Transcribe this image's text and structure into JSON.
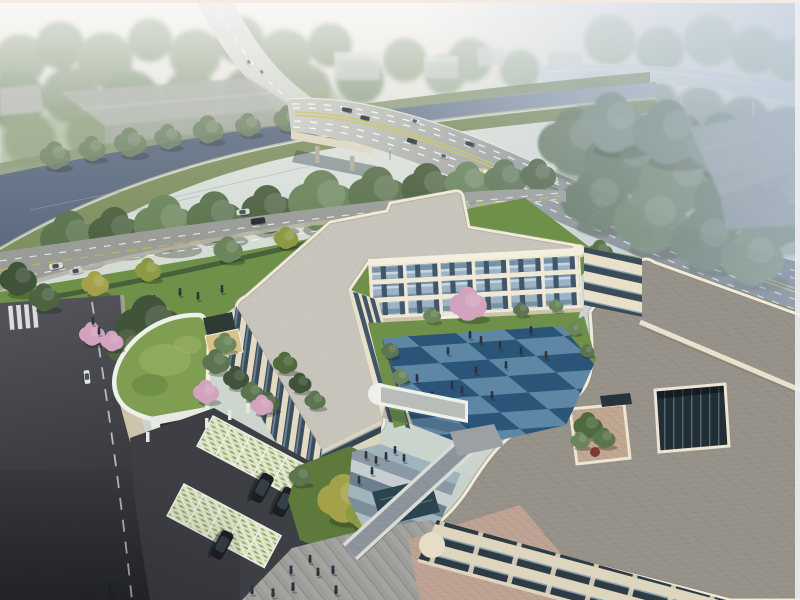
{
  "scene": {
    "title": "Aerial architectural rendering of a cream three-storey courtyard campus beside a canal and a curving elevated highway",
    "style": "daytime hazy architectural visualization, no visible text",
    "view": "high-angle aerial view looking toward a tree-lined canal, a road bridge and distant forest"
  },
  "features": [
    "hazy sky band",
    "distant forest",
    "distant highway ramp",
    "canal with bridge",
    "tree rows along canal",
    "main avenue with traffic",
    "local street",
    "cream building complex with rounded corners",
    "blue checkerboard courtyard with pedestrians",
    "grey paver roof with square skylight opening",
    "roof terrace with planting",
    "curved green-roof gatehouse",
    "entry gate and driveway",
    "grass-paver parking bays with black SUVs",
    "front plaza with pedestrians",
    "pink blossom trees"
  ],
  "counts": {
    "highway_cars": 9,
    "highway_buses": 1,
    "street_cars": 2,
    "parked_vans": 2,
    "access_road_cars": 2,
    "parked_suvs": 3,
    "distant_buildings": 4,
    "canal_warehouses": 3,
    "people_courtyard": 14,
    "people_forecourt": 7,
    "people_plaza": 8,
    "people_lawn": 4,
    "people_path": 2,
    "blossom_trees": 5
  },
  "colors": {
    "top_border": "#f3eae3",
    "right_border": "#edf0f2",
    "canal_water": "#5d6c80",
    "street_asphalt": "#9a9d97",
    "driveway_asphalt": "#3d3f44",
    "roof_left_wing": "#c8c5bd",
    "roof_right_wing": "#97928a",
    "facade_cream": "#efe8d4",
    "parapet_cream": "#f0ead9",
    "courtyard_tile_light": "#5e87a5",
    "courtyard_tile_dark": "#2b5578",
    "lawn": "#6f9049",
    "green_roof": "#7f9e52",
    "plaza_paving": "#9c9c99",
    "paving_tan": "#bfa496",
    "pool_water": "#2b454e",
    "blossom_pink": "#d2a3be",
    "suv_black": "#1b1e23",
    "bus_yellow": "#d8c36c",
    "car_red": "#8e2a26",
    "haze_blue": "#b5c5d8",
    "glass_dark": "#41566a",
    "glass_light": "#9cb3c4"
  }
}
